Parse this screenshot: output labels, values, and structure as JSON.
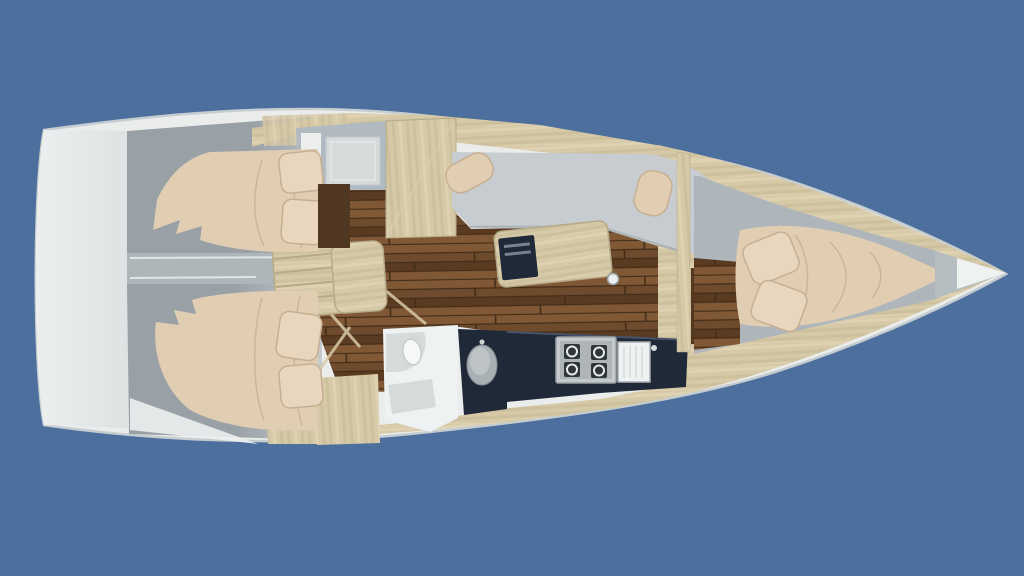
{
  "meta": {
    "scene": "Sailing yacht interior layout, top-down 3D rendering",
    "orientation": "bow-right-stern-left",
    "background_style": "solid steel blue"
  },
  "layout": {
    "rooms": [
      "stern-transom-platform",
      "aft-cabin-port",
      "aft-cabin-starboard",
      "companionway-steps",
      "saloon-with-wood-floor",
      "saloon-settee",
      "saloon-table",
      "forward-head-compartment",
      "wardrobe",
      "aft-head-compartment-with-vanity",
      "galley-with-stove-and-sink",
      "forward-cabin-v-berth",
      "bow-anchor-locker"
    ],
    "furniture": [
      "double-bed-aft-port",
      "double-bed-aft-starboard",
      "v-berth-bed",
      "pillows",
      "dining-table-with-dark-insert",
      "settee-cushions",
      "four-burner-stove",
      "sink-unit",
      "vanity-basin",
      "toilet",
      "shower-tray",
      "companionway-ladder",
      "mast-post"
    ]
  },
  "colors": {
    "bg": "#4C6F9D",
    "hullWhite": "#EBEDEC",
    "hullRim": "#C6CDD1",
    "deckGray": "#C2C8CB",
    "transomWhite": "#EDEFEF",
    "cabinGrayDark": "#99A1A7",
    "cabinGrayLight": "#C5CACD",
    "dividerGray": "#AFB6BA",
    "upholstery": "#C7CCD0",
    "upholsteryShadow": "#9FA7AD",
    "bedding": "#E0CDB2",
    "beddingLight": "#E8D7BE",
    "beddingShadow": "#C7AF92",
    "woodLight": "#D6C9A7",
    "woodStripeA": "#CDC09D",
    "woodStripeB": "#DED2B2",
    "woodEdge": "#B7AA89",
    "floorBase": "#6F4B2D",
    "floorLight": "#815836",
    "floorDark": "#5A3B22",
    "floorSeam": "#432D18",
    "darkDoorway": "#54381F",
    "darkPanel": "#503722",
    "counterNavy": "#1F2938",
    "counterEdge": "#46536A",
    "steel": "#C4C9CB",
    "steelDark": "#9AA0A3",
    "burnerDark": "#2F363B",
    "fixtureWhite": "#EFF2F2",
    "fixtureGray": "#D6DADB",
    "basinGray": "#AAB1B5",
    "headWall": "#B2BAC1",
    "bowShadow": "#B6BDC0",
    "bowWhite": "#EEF2F1"
  }
}
